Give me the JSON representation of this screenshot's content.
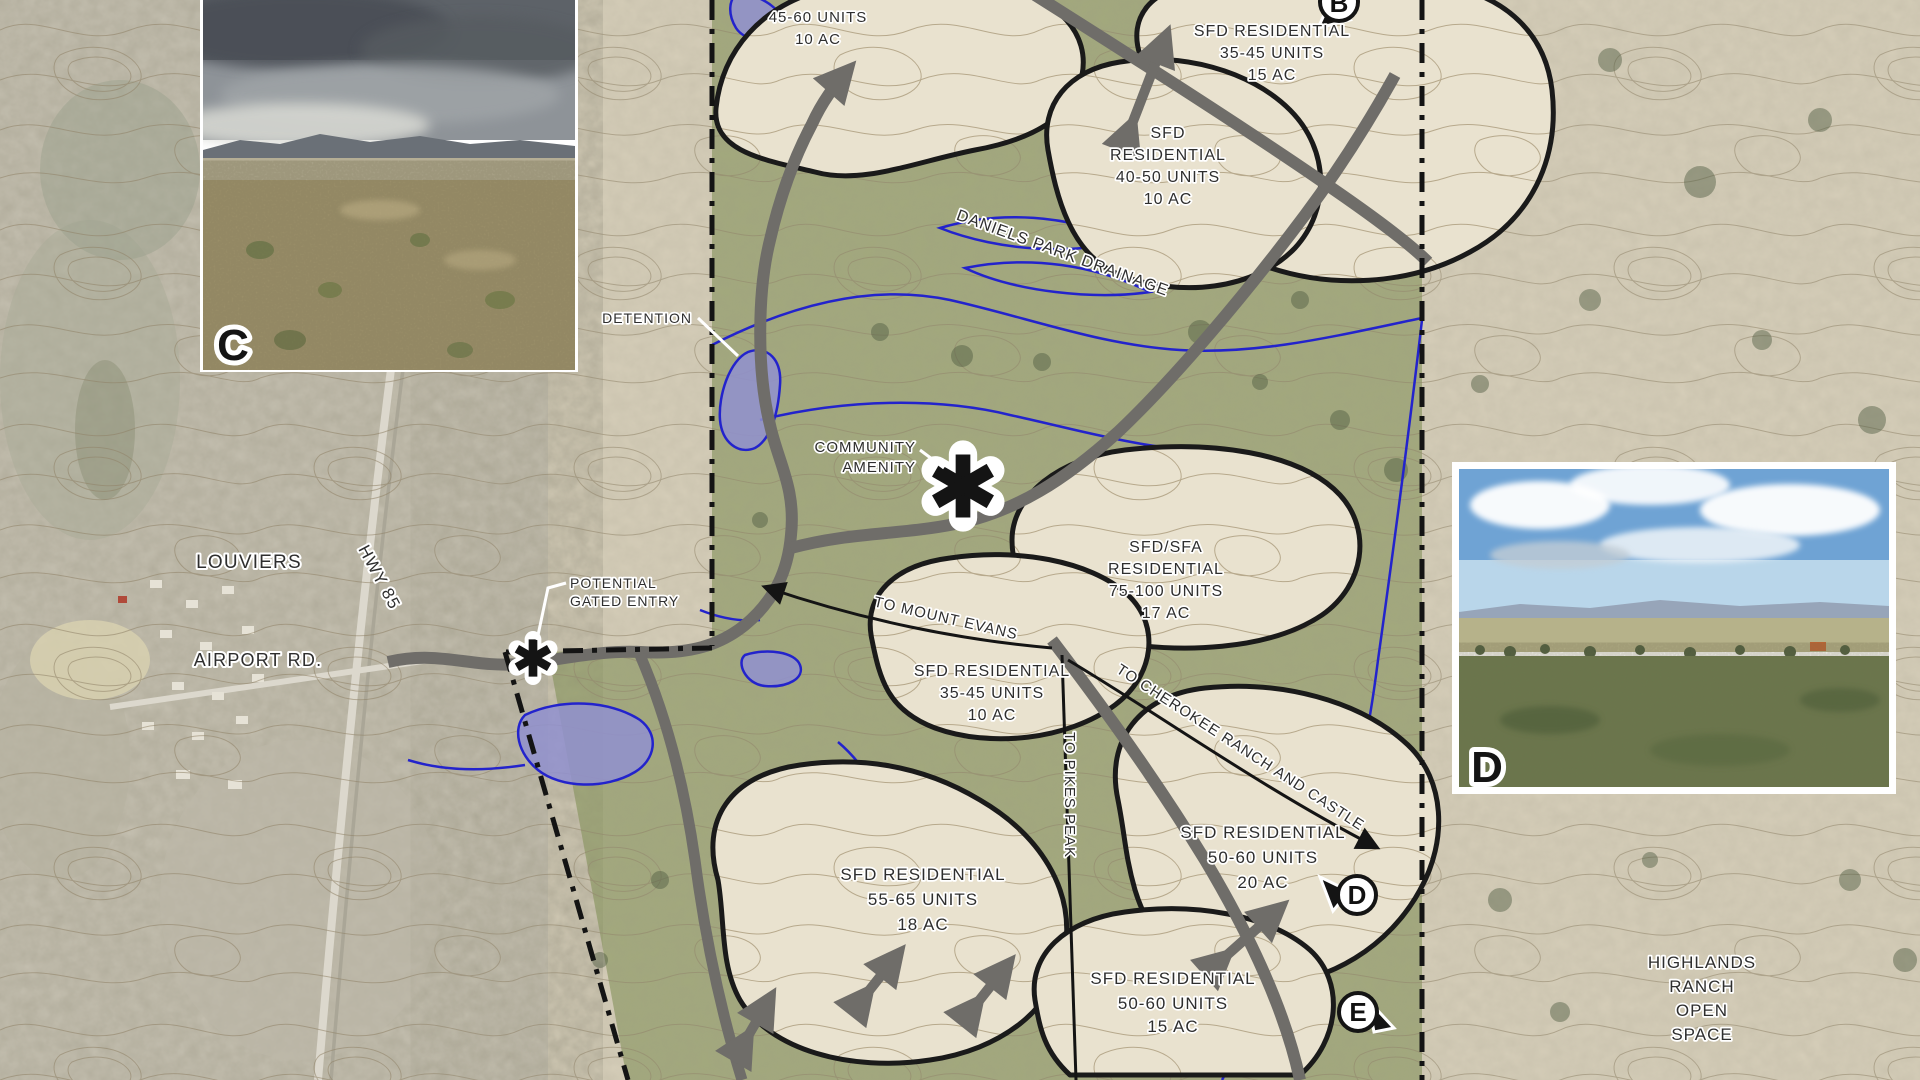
{
  "title": "Residential development land plan over aerial topographic map",
  "labels": {
    "louviers": "LOUVIERS",
    "hwy85": "HWY 85",
    "airport_rd": "AIRPORT RD.",
    "daniels": "DANIELS PARK DRAINAGE",
    "highlands": [
      "HIGHLANDS",
      "RANCH",
      "OPEN",
      "SPACE"
    ]
  },
  "annotations": {
    "detention": "DETENTION",
    "community_amenity": [
      "COMMUNITY",
      "AMENITY"
    ],
    "gated_entry": [
      "POTENTIAL",
      "GATED ENTRY"
    ],
    "to_mount_evans": "TO MOUNT EVANS",
    "to_pikes_peak": "TO PIKES PEAK",
    "to_cherokee": "TO CHEROKEE RANCH AND CASTLE"
  },
  "parcels": [
    {
      "lines": [
        "45-60 UNITS",
        "10 AC"
      ]
    },
    {
      "lines": [
        "SFD RESIDENTIAL",
        "35-45 UNITS",
        "15 AC"
      ]
    },
    {
      "lines": [
        "SFD",
        "RESIDENTIAL",
        "40-50 UNITS",
        "10 AC"
      ]
    },
    {
      "lines": [
        "SFD/SFA",
        "RESIDENTIAL",
        "75-100 UNITS",
        "17 AC"
      ]
    },
    {
      "lines": [
        "SFD RESIDENTIAL",
        "35-45 UNITS",
        "10 AC"
      ]
    },
    {
      "lines": [
        "SFD RESIDENTIAL",
        "55-65 UNITS",
        "18 AC"
      ]
    },
    {
      "lines": [
        "SFD RESIDENTIAL",
        "50-60 UNITS",
        "20 AC"
      ]
    },
    {
      "lines": [
        "SFD RESIDENTIAL",
        "50-60 UNITS",
        "15 AC"
      ]
    }
  ],
  "markers": {
    "top": "B",
    "d": "D",
    "e": "E"
  },
  "photos": {
    "c": "C",
    "d": "D"
  },
  "colors": {
    "topo_tan": "#d8d0bb",
    "green_zone": "#7e8f52",
    "parcel_fill": "#e9e2cf",
    "road_gray": "#6f6d69",
    "water_blue": "#2323cc",
    "pond_fill": "#9191cf",
    "boundary_black": "#141414",
    "label_ink": "#2e2e2e"
  }
}
